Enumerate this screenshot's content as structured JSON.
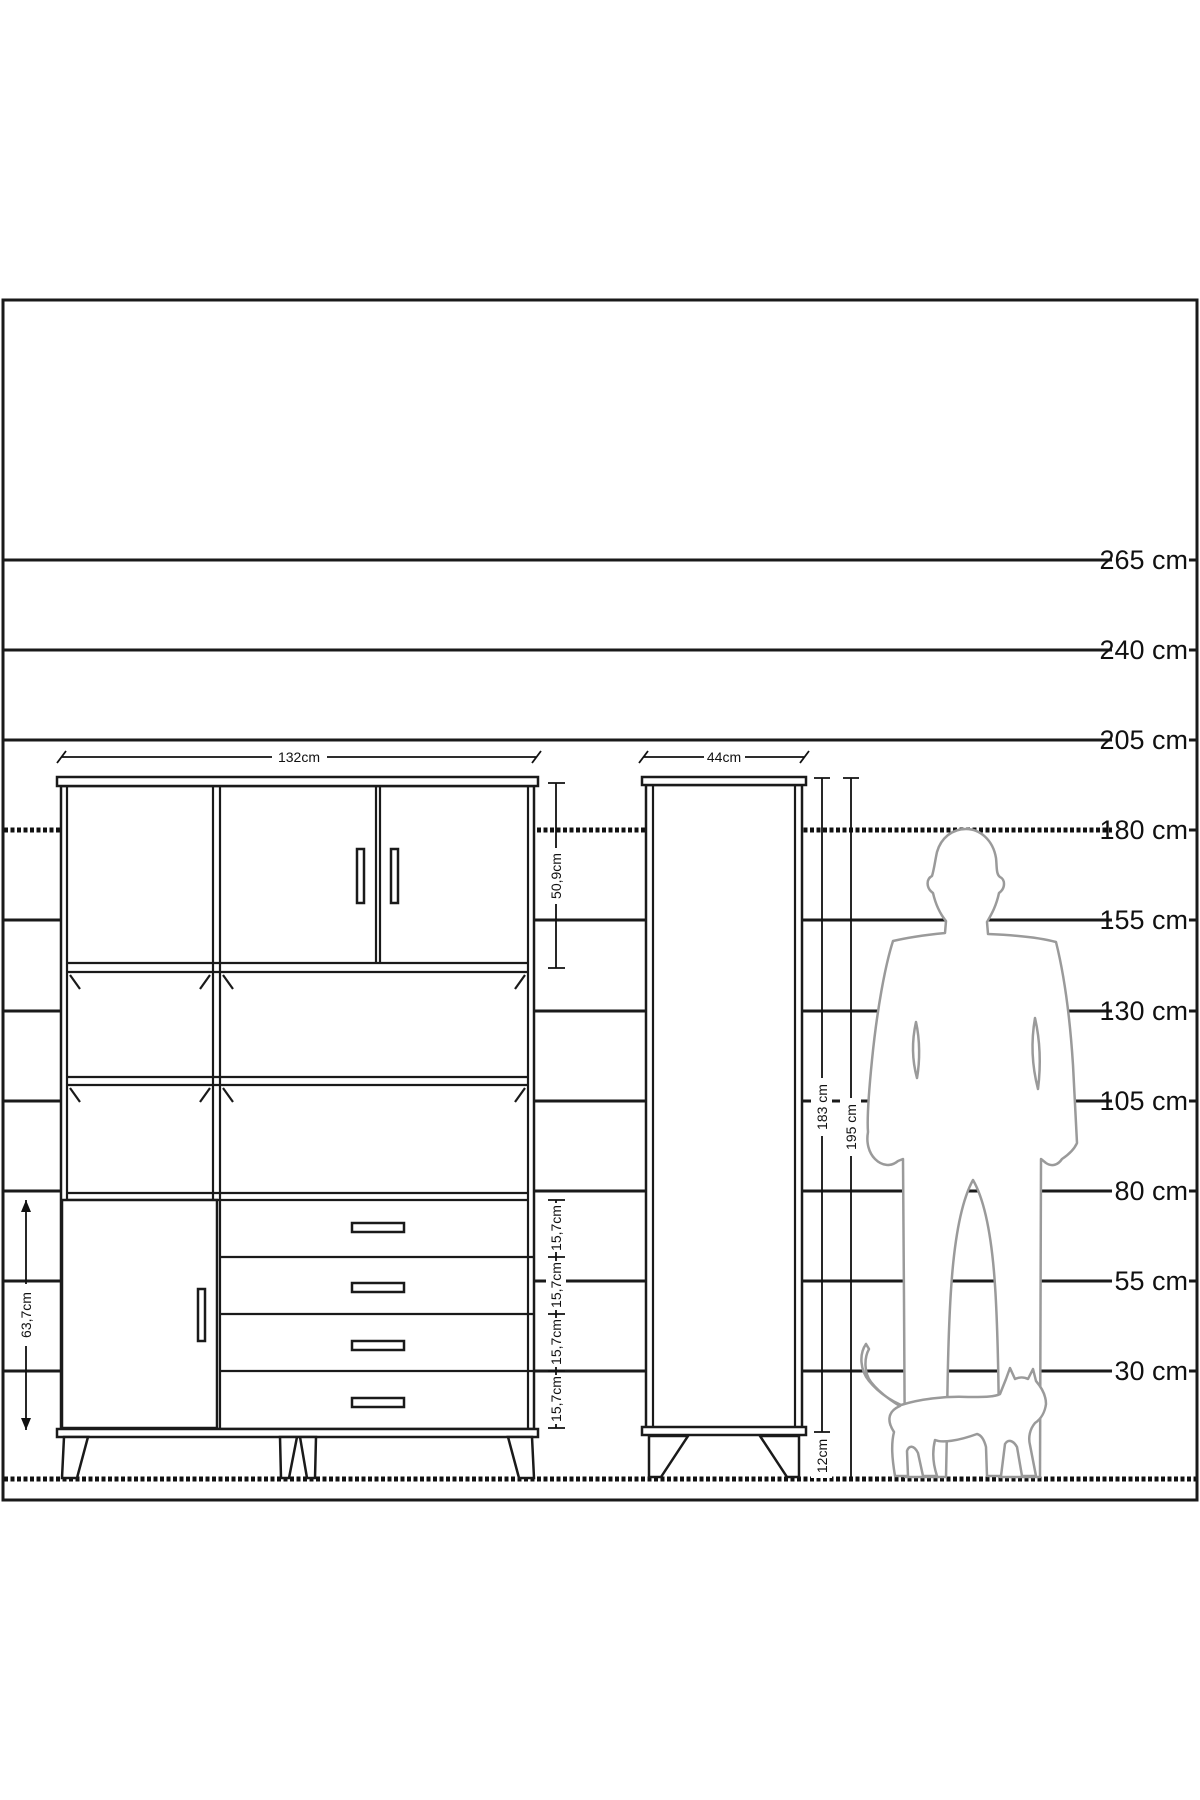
{
  "scale": {
    "unit": "cm",
    "labels": [
      "265 cm",
      "240 cm",
      "205 cm",
      "180 cm",
      "155 cm",
      "130 cm",
      "105 cm",
      "80 cm",
      "55 cm",
      "30 cm"
    ]
  },
  "large_cabinet": {
    "width_label": "132cm",
    "top_section_height_label": "50,9cm",
    "left_door_height_label": "63,7cm",
    "drawer_height_labels": [
      "15,7cm",
      "15,7cm",
      "15,7cm",
      "15,7cm"
    ]
  },
  "small_cabinet": {
    "width_label": "44cm",
    "body_height_label": "183 cm",
    "total_height_label": "195 cm",
    "leg_height_label": "12cm"
  },
  "colors": {
    "line": "#1a1a1a",
    "silhouette": "#9a9a9a",
    "background": "#ffffff"
  }
}
